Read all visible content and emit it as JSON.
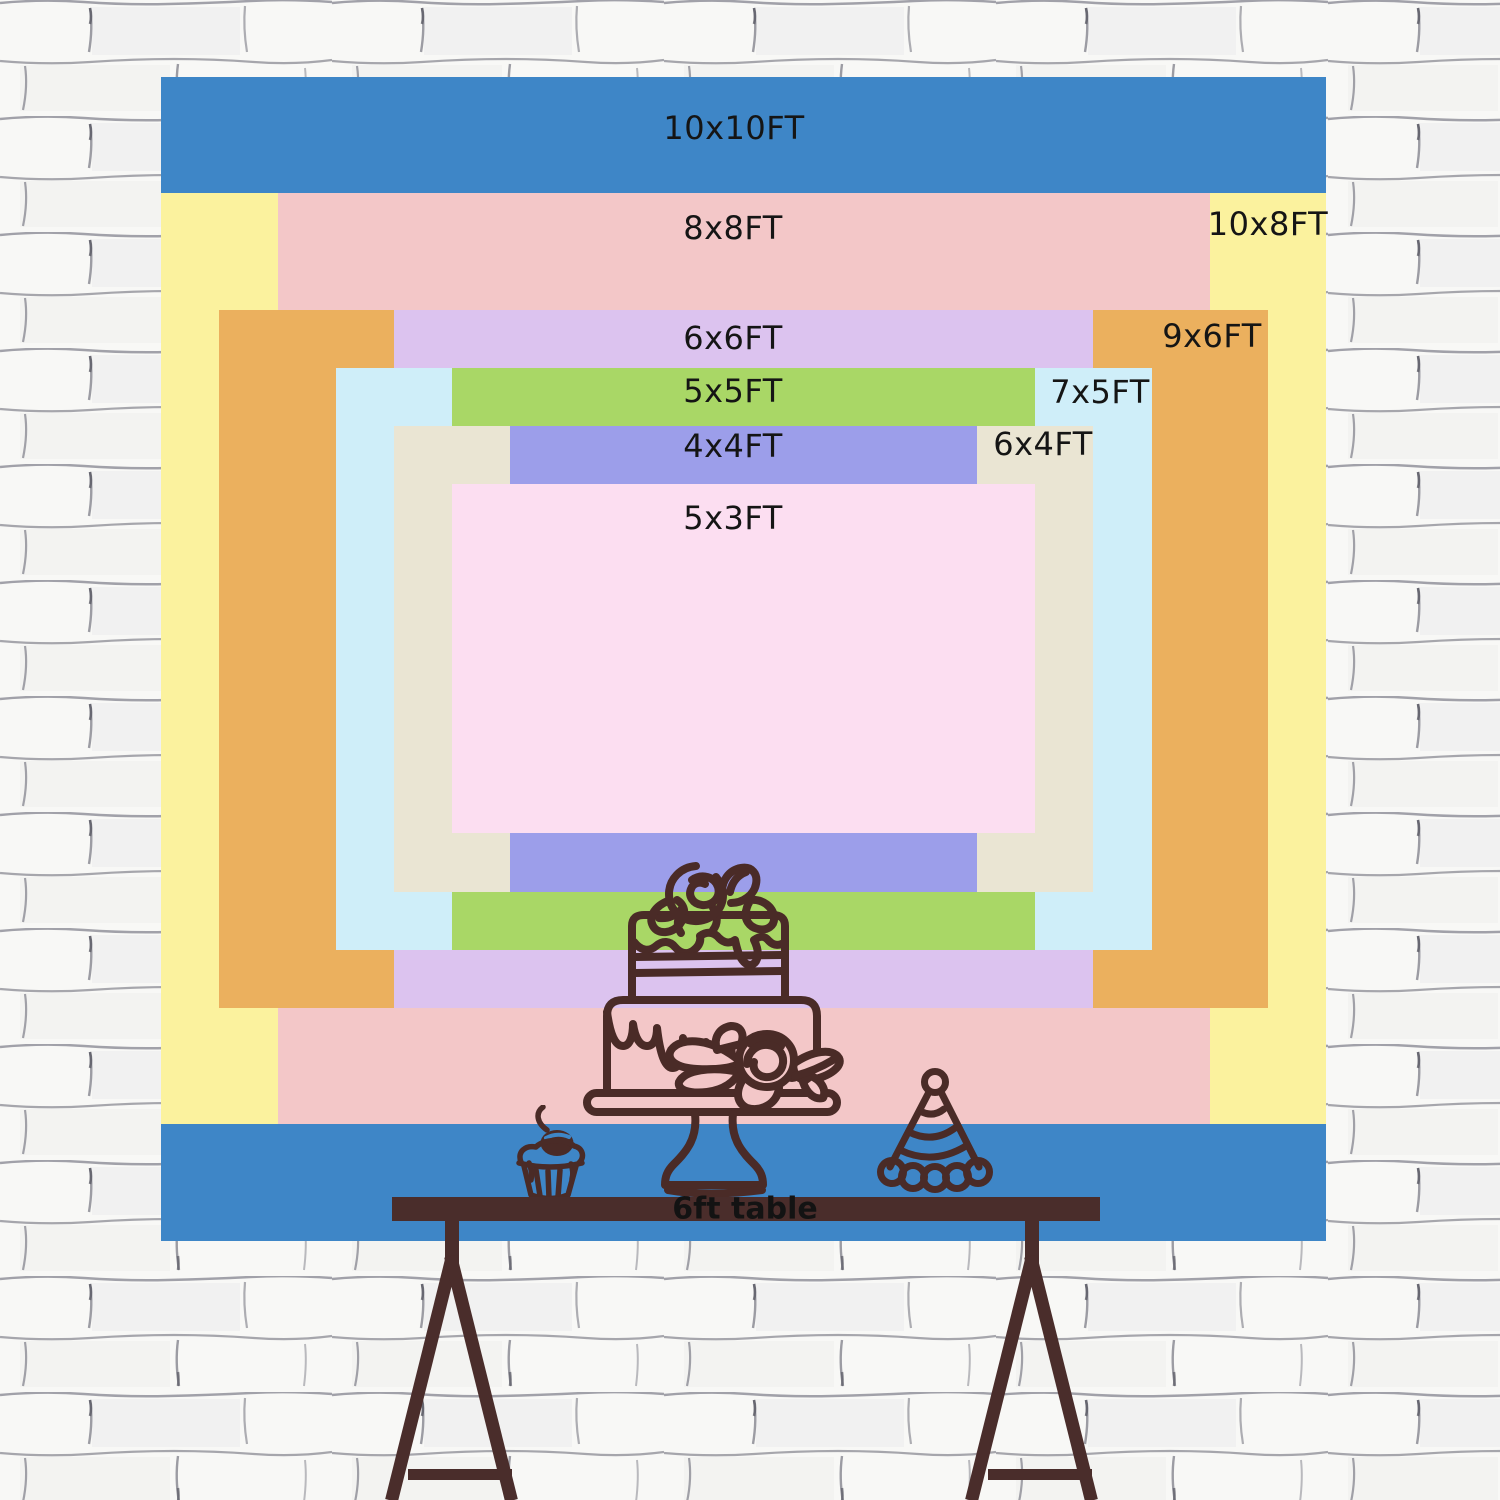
{
  "backdrop": {
    "sizes": [
      {
        "id": "10x10ft",
        "label": "10x10FT",
        "color": "#3e86c7"
      },
      {
        "id": "10x8ft",
        "label": "10x8FT",
        "color": "#fbf29e"
      },
      {
        "id": "8x8ft",
        "label": "8x8FT",
        "color": "#f3c7c8"
      },
      {
        "id": "9x6ft",
        "label": "9x6FT",
        "color": "#ebb05e"
      },
      {
        "id": "6x6ft",
        "label": "6x6FT",
        "color": "#dcc3ef"
      },
      {
        "id": "7x5ft",
        "label": "7x5FT",
        "color": "#cfeef9"
      },
      {
        "id": "5x5ft",
        "label": "5x5FT",
        "color": "#a9d766"
      },
      {
        "id": "6x4ft",
        "label": "6x4FT",
        "color": "#eae5d3"
      },
      {
        "id": "4x4ft",
        "label": "4x4FT",
        "color": "#9c9eea"
      },
      {
        "id": "5x3ft",
        "label": "5x3FT",
        "color": "#fcdef1"
      }
    ]
  },
  "table": {
    "label": "6ft table"
  },
  "illustration": {
    "items": [
      "tiered-cake-icon",
      "cupcake-icon",
      "party-hat-icon"
    ]
  },
  "theme": {
    "label_color": "#151515",
    "table_label_color": "#131313",
    "wood_color": "#4a2d2b",
    "line_color": "#4a2b27",
    "flower_fill": "#f3c7c8",
    "cherry_highlight": "#3e86c7",
    "wall_base": "#f8f8f6",
    "wall_mortar": "#84848e",
    "wall_accent": "#5a5a64"
  }
}
